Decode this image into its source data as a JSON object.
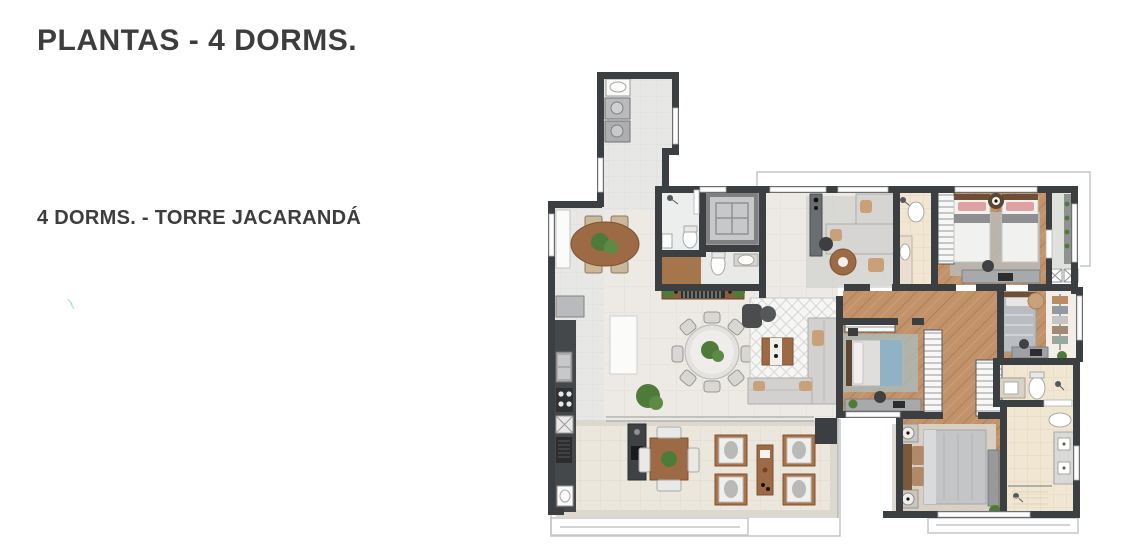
{
  "header": {
    "title": "PLANTAS - 4 DORMS."
  },
  "plan": {
    "variant_label": "4 DORMS. - TORRE JACARANDÁ"
  },
  "floorplan": {
    "kind": "apartment-floor-plan-top-view",
    "rooms": [
      "laundry",
      "service-hall",
      "breakfast-room",
      "kitchen",
      "bathroom-service",
      "elevator",
      "powder-room",
      "entry-hall",
      "tv-room",
      "living-room",
      "dining-area",
      "terrace",
      "twin-bedroom",
      "twin-bathroom",
      "balcony",
      "bedroom-2",
      "bedroom-3",
      "closet-hall",
      "master-bedroom",
      "small-bathroom",
      "master-bathroom"
    ],
    "colors": {
      "wall": "#3c3f42",
      "social_floor": "#edeae6",
      "service_floor": "#e7e7e5",
      "wood_floor": "#c2926a",
      "bath_floor": "#f1e6d2",
      "terrace_floor": "#ebe7dc",
      "rug_gray": "#bcbdbb",
      "rug_teal": "#a9bcba",
      "bed_blue": "#8fb3c4",
      "pillow_pink": "#dfa0a2",
      "furniture_wood": "#9c6b45",
      "plant_green": "#4e7a3a",
      "outline": "#c6c6c6",
      "text": "#3d3d3d",
      "background": "#ffffff"
    }
  }
}
